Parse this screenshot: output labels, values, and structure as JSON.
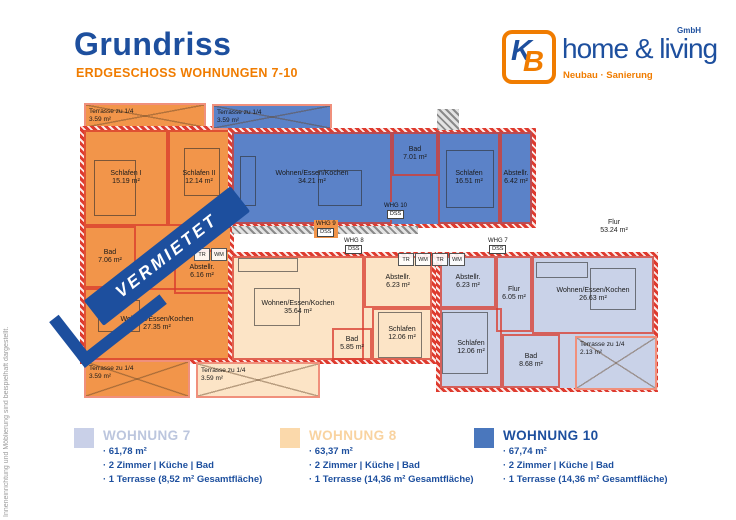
{
  "header": {
    "title": "Grundriss",
    "subtitle": "ERDGESCHOSS WOHNUNGEN 7-10"
  },
  "logo": {
    "k": "K",
    "b": "B",
    "name": "home & living",
    "gmbh": "GmbH",
    "tagline": "Neubau · Sanierung"
  },
  "side_note": "Inneneinrichtung und Möblierung sind beispielhaft dargestellt.",
  "banner": "VERMIETET",
  "plan": {
    "hall": {
      "name": "Flur",
      "area": "53.24 m²"
    },
    "appliances": {
      "tr": "TR",
      "wm": "WM"
    },
    "tags": {
      "w9": {
        "l1": "WHG 9",
        "l2": "DSS"
      },
      "w10": {
        "l1": "WHG 10",
        "l2": "DSS"
      },
      "w8": {
        "l1": "WHG 8",
        "l2": "DSS"
      },
      "w7": {
        "l1": "WHG 7",
        "l2": "DSS"
      }
    },
    "w9": {
      "terrasse_top": {
        "name": "Terrasse zu 1/4",
        "area": "3.59 m²"
      },
      "schlafen1": {
        "name": "Schlafen I",
        "area": "15.19 m²"
      },
      "schlafen2": {
        "name": "Schlafen II",
        "area": "12.14 m²"
      },
      "bad": {
        "name": "Bad",
        "area": "7.06 m²"
      },
      "abstell": {
        "name": "Abstellr.",
        "area": "6.16 m²"
      },
      "wohnen": {
        "name": "Wohnen/Essen/Kochen",
        "area": "27.35 m²"
      },
      "terrasse_bottom": {
        "name": "Terrasse zu 1/4",
        "area": "3.59 m²"
      }
    },
    "w10": {
      "terrasse": {
        "name": "Terrasse zu 1/4",
        "area": "3.59 m²"
      },
      "wohnen": {
        "name": "Wohnen/Essen/Kochen",
        "area": "34.21 m²"
      },
      "bad": {
        "name": "Bad",
        "area": "7.01 m²"
      },
      "schlafen": {
        "name": "Schlafen",
        "area": "16.51 m²"
      },
      "abstell": {
        "name": "Abstellr.",
        "area": "6.42 m²"
      }
    },
    "w8": {
      "wohnen": {
        "name": "Wohnen/Essen/Kochen",
        "area": "35.64 m²"
      },
      "abstell": {
        "name": "Abstellr.",
        "area": "6.23 m²"
      },
      "schlafen": {
        "name": "Schlafen",
        "area": "12.06 m²"
      },
      "bad": {
        "name": "Bad",
        "area": "5.85 m²"
      },
      "terrasse": {
        "name": "Terrasse zu 1/4",
        "area": "3.59 m²"
      }
    },
    "w7": {
      "abstell": {
        "name": "Abstellr.",
        "area": "6.23 m²"
      },
      "schlafen": {
        "name": "Schlafen",
        "area": "12.06 m²"
      },
      "flur": {
        "name": "Flur",
        "area": "6.05 m²"
      },
      "wohnen": {
        "name": "Wohnen/Essen/Kochen",
        "area": "26.63 m²"
      },
      "bad": {
        "name": "Bad",
        "area": "8.68 m²"
      },
      "terrasse": {
        "name": "Terrasse zu 1/4",
        "area": "2.13 m²"
      }
    }
  },
  "legend": {
    "items": [
      {
        "title": "WOHNUNG 7",
        "lines": [
          "· 61,78 m²",
          "· 2 Zimmer | Küche | Bad",
          "· 1 Terrasse (8,52 m² Gesamtfläche)"
        ]
      },
      {
        "title": "WOHNUNG 8",
        "lines": [
          "· 63,37 m²",
          "· 2 Zimmer | Küche | Bad",
          "· 1 Terrasse (14,36 m² Gesamtfläche)"
        ]
      },
      {
        "title": "WOHNUNG 10",
        "lines": [
          "· 67,74 m²",
          "· 2 Zimmer | Küche | Bad",
          "· 1 Terrasse (14,36 m² Gesamtfläche)"
        ]
      }
    ]
  },
  "colors": {
    "brand_blue": "#1d4f9e",
    "brand_orange": "#f07c00",
    "wall_red": "#de3a2e",
    "banner_blue": "#1d4f9e",
    "note_gray": "#9b9b9b",
    "w9_fill": "#f2954a",
    "w10_fill": "#5b82c8",
    "w8_fill": "#fce4c6",
    "w7_fill": "#c9d2e8",
    "legend_w7_swatch": "#c9d0e8",
    "legend_w8_swatch": "#fbd9ab",
    "legend_w10_swatch": "#4a77bd",
    "legend_w7_title": "#bcc6de",
    "legend_w8_title": "#f9d3a0"
  }
}
